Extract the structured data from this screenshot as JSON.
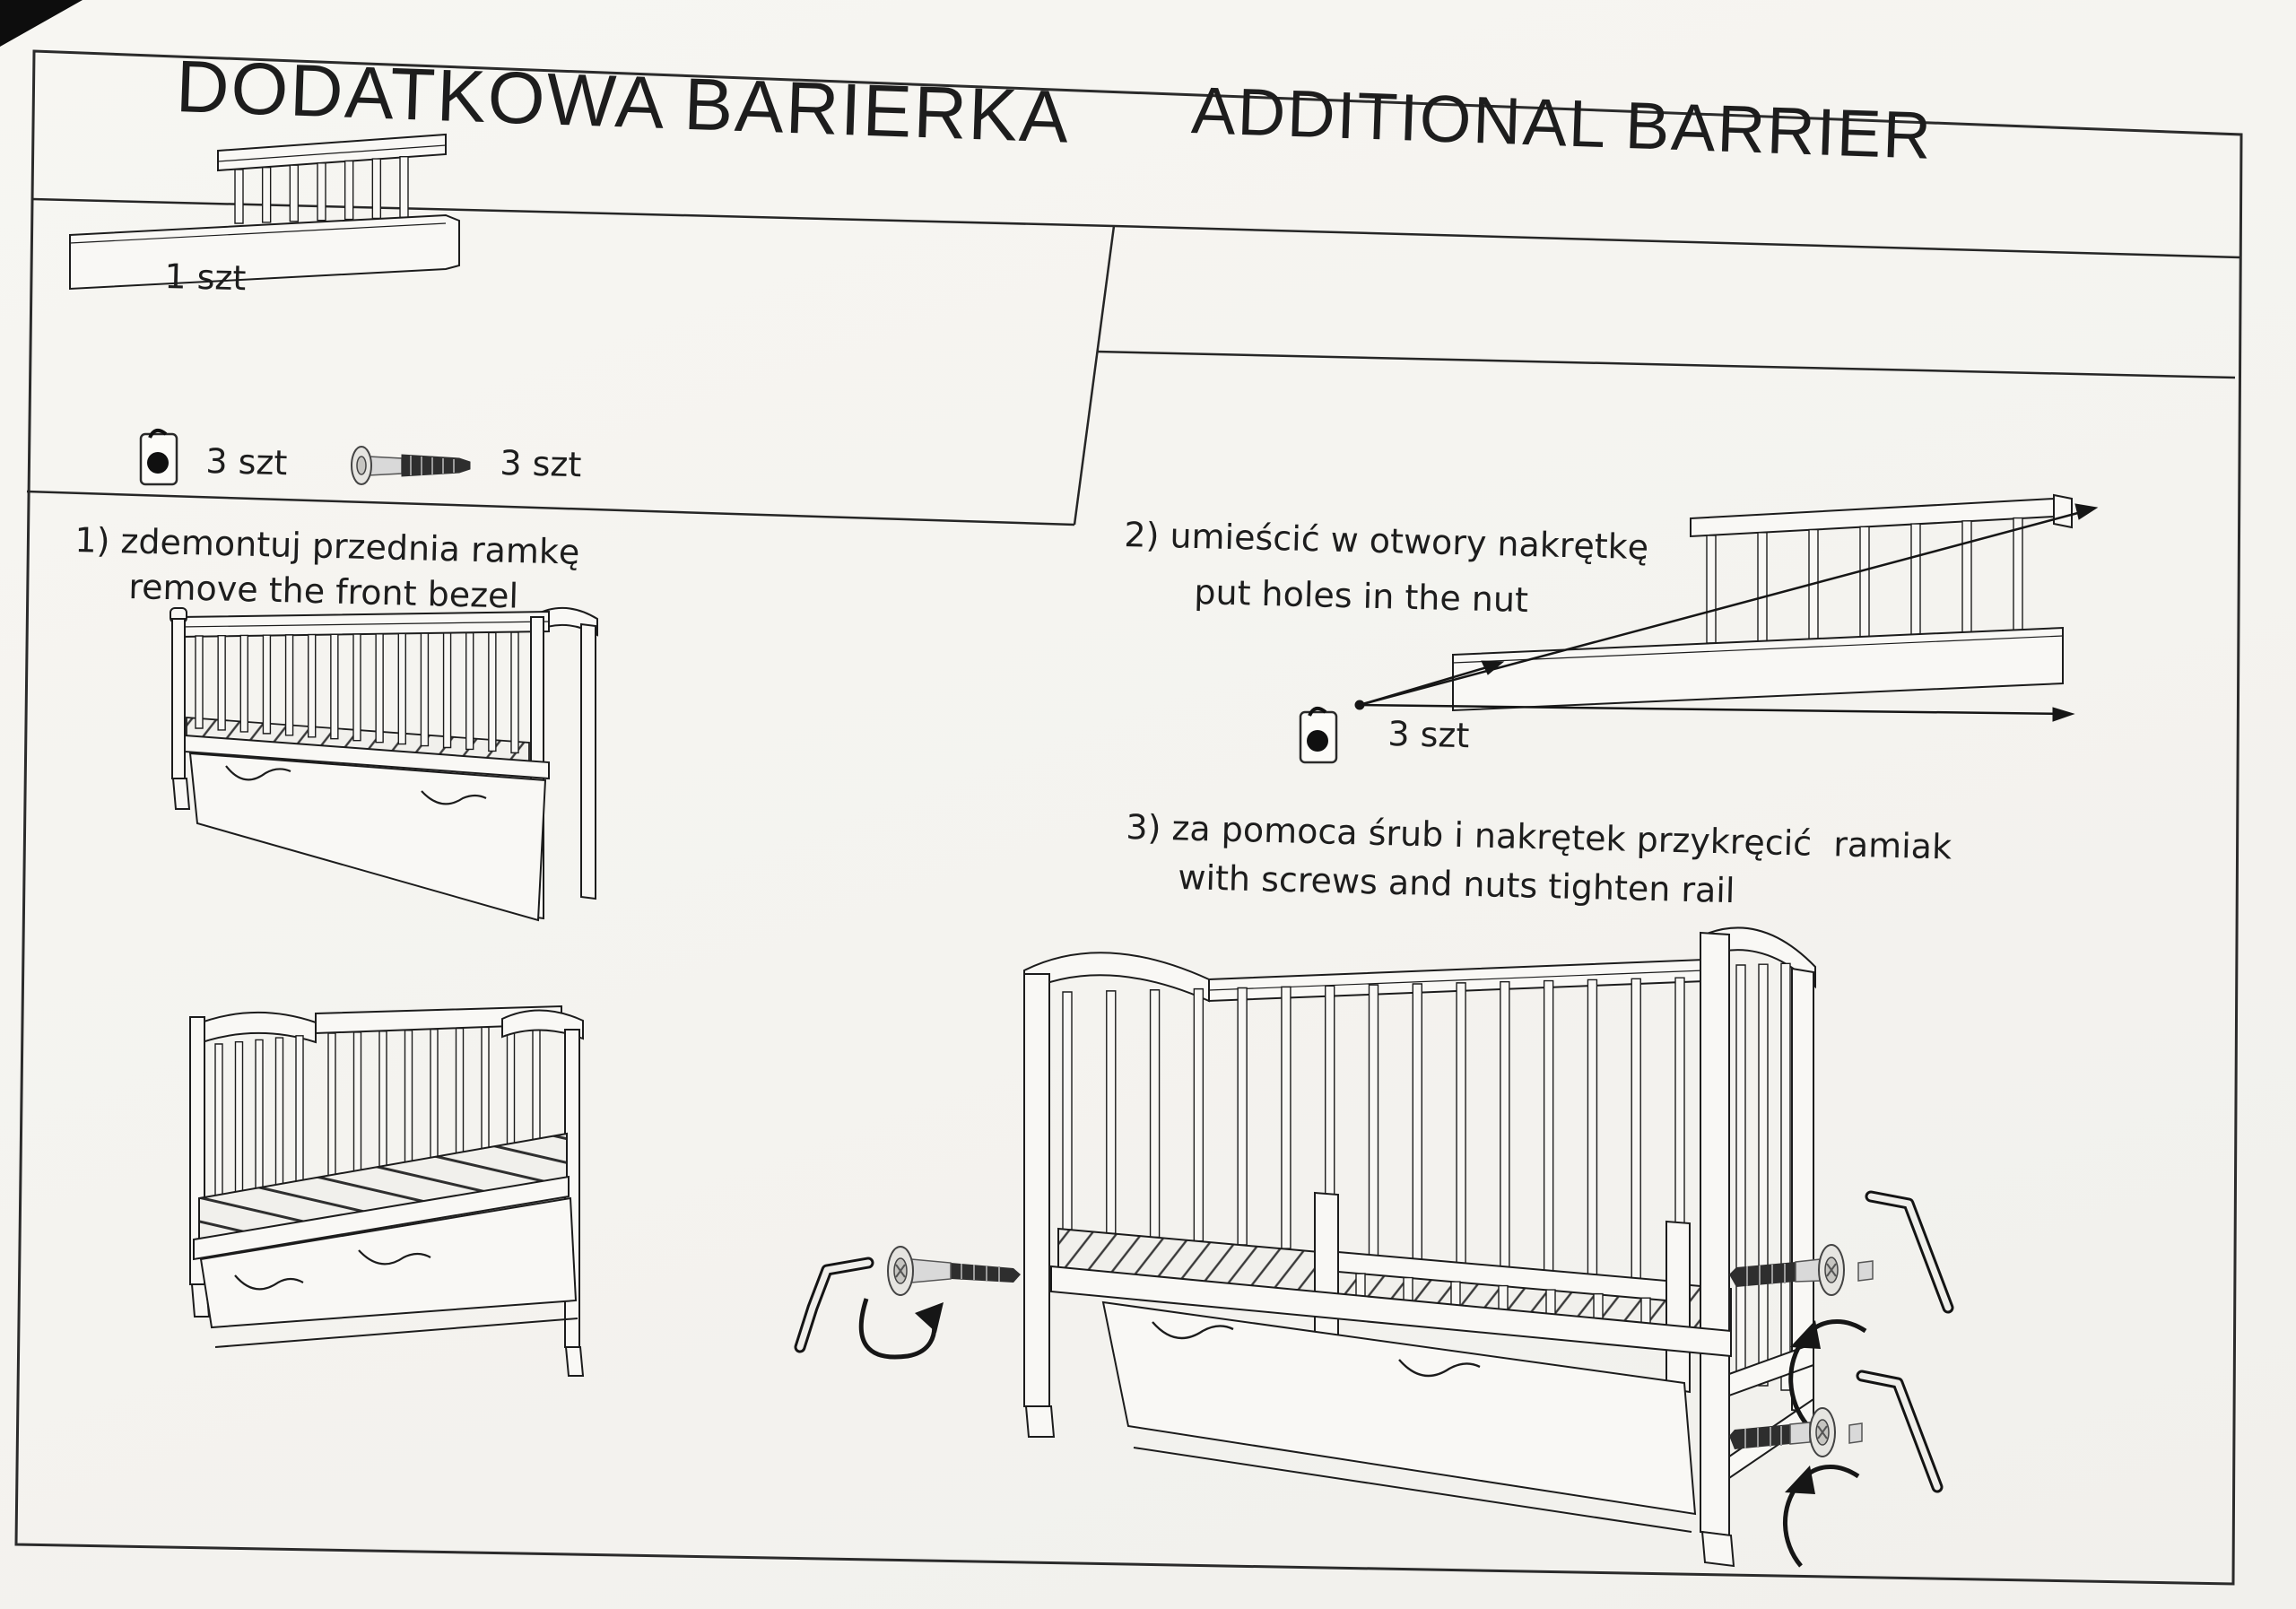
{
  "page": {
    "title_pl": "DODATKOWA BARIERKA",
    "title_en": "ADDITIONAL BARRIER",
    "parts_list": {
      "barrier": {
        "qty": "1 szt"
      },
      "nut": {
        "qty": "3 szt"
      },
      "screw": {
        "qty": "3 szt"
      }
    },
    "steps": [
      {
        "pl": "1) zdemontuj przednia ramkę",
        "en": "remove the front bezel"
      },
      {
        "pl": "2) umieścić w otwory nakrętkę",
        "en": "put holes in the nut",
        "nut_qty": "3 szt"
      },
      {
        "pl": "3) za pomoca śrub i nakrętek przykręcić  ramiak",
        "en": "with screws and nuts tighten rail"
      }
    ],
    "colors": {
      "paper": "#f6f5f1",
      "ink": "#1c1c1c",
      "screw_dark": "#2e2e2e",
      "metal_light": "#d9d9d9"
    }
  }
}
